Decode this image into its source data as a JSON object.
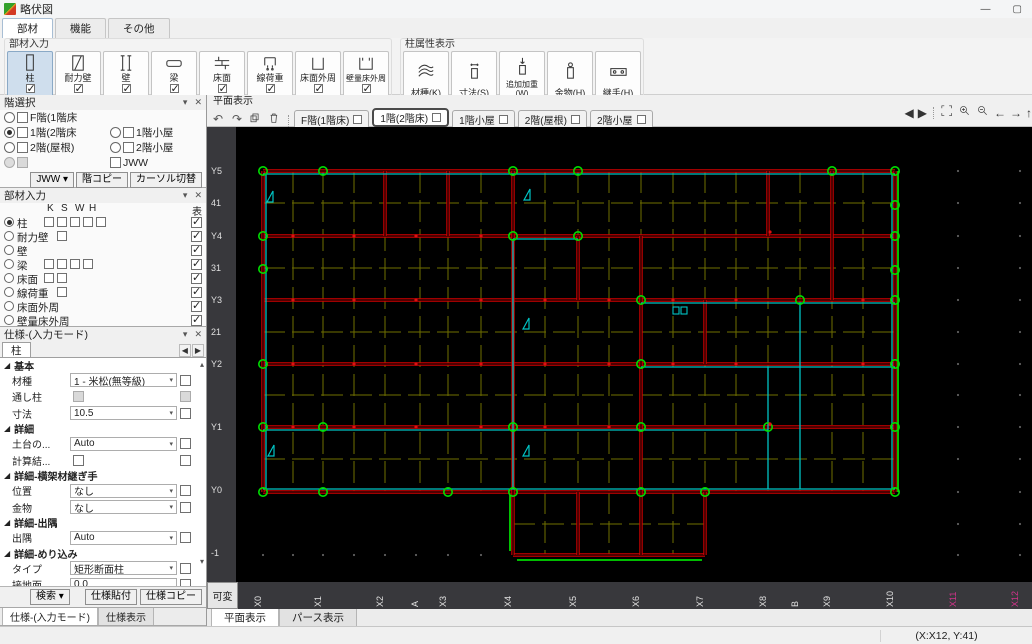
{
  "window": {
    "title": "略伏図",
    "controls": {
      "minimize": "—",
      "maximize": "▢"
    }
  },
  "ribbon": {
    "tabs": [
      {
        "label": "部材",
        "active": true
      },
      {
        "label": "機能",
        "active": false
      },
      {
        "label": "その他",
        "active": false
      }
    ],
    "member_group": {
      "title": "部材入力",
      "buttons": [
        {
          "label": "柱",
          "icon": "post-icon",
          "checked": true,
          "selected": true
        },
        {
          "label": "耐力壁",
          "icon": "bearing-wall-icon",
          "checked": true,
          "selected": false
        },
        {
          "label": "壁",
          "icon": "wall-icon",
          "checked": true,
          "selected": false
        },
        {
          "label": "梁",
          "icon": "beam-icon",
          "checked": true,
          "selected": false
        },
        {
          "label": "床面",
          "icon": "floor-icon",
          "checked": true,
          "selected": false
        },
        {
          "label": "線荷重",
          "icon": "line-load-icon",
          "checked": true,
          "selected": false
        },
        {
          "label": "床面外周",
          "icon": "floor-perimeter-icon",
          "checked": true,
          "selected": false
        },
        {
          "label": "壁量床外周",
          "icon": "wall-floor-perimeter-icon",
          "checked": true,
          "selected": false
        }
      ]
    },
    "attr_group": {
      "title": "柱属性表示",
      "buttons": [
        {
          "label": "材種(K)",
          "icon": "material-icon"
        },
        {
          "label": "寸法(S)",
          "icon": "size-icon"
        },
        {
          "label": "追加加重(W)",
          "icon": "added-load-icon"
        },
        {
          "label": "金物(H)",
          "icon": "hardware-icon"
        },
        {
          "label": "継手(H)",
          "icon": "joint-icon"
        }
      ]
    }
  },
  "floor_panel": {
    "title": "階選択",
    "rows": [
      {
        "col1": {
          "radio": true,
          "selected": false,
          "checkbox": true,
          "label": "F階(1階床"
        },
        "col2": null
      },
      {
        "col1": {
          "radio": true,
          "selected": true,
          "checkbox": true,
          "label": "1階(2階床"
        },
        "col2": {
          "radio": true,
          "selected": false,
          "checkbox": true,
          "label": "1階小屋"
        }
      },
      {
        "col1": {
          "radio": true,
          "selected": false,
          "checkbox": true,
          "label": "2階(屋根)"
        },
        "col2": {
          "radio": true,
          "selected": false,
          "checkbox": true,
          "label": "2階小屋"
        }
      },
      {
        "col1": {
          "radio": true,
          "disabled": true,
          "checkbox": true,
          "label": ""
        },
        "col2": {
          "radio": false,
          "checkbox": true,
          "label": "JWW"
        }
      }
    ],
    "buttons": [
      {
        "label": "JWW",
        "dropdown": true
      },
      {
        "label": "階コピー",
        "dropdown": false
      },
      {
        "label": "カーソル切替",
        "dropdown": false
      }
    ]
  },
  "member_panel": {
    "title": "部材入力",
    "col_letters": [
      "K",
      "S",
      "W",
      "H"
    ],
    "col_show": "表",
    "rows": [
      {
        "label": "柱",
        "selected": true,
        "boxes": 5,
        "offset": 0,
        "show": true
      },
      {
        "label": "耐力壁",
        "selected": false,
        "boxes": 1,
        "offset": 1,
        "show": true
      },
      {
        "label": "壁",
        "selected": false,
        "boxes": 0,
        "offset": 0,
        "show": true
      },
      {
        "label": "梁",
        "selected": false,
        "boxes": 4,
        "offset": 0,
        "show": true
      },
      {
        "label": "床面",
        "selected": false,
        "boxes": 2,
        "offset": 0,
        "show": true
      },
      {
        "label": "線荷重",
        "selected": false,
        "boxes": 1,
        "offset": 1,
        "show": true
      },
      {
        "label": "床面外周",
        "selected": false,
        "boxes": 0,
        "offset": 0,
        "show": true
      },
      {
        "label": "壁量床外周",
        "selected": false,
        "boxes": 0,
        "offset": 0,
        "show": true
      }
    ]
  },
  "spec_panel": {
    "title": "仕様-(入力モード)",
    "tab": "柱",
    "sections": [
      {
        "header": "基本",
        "rows": [
          {
            "label": "材種",
            "value": "1 - 米松(無等級)",
            "type": "select"
          },
          {
            "label": "通し柱",
            "value": "",
            "type": "disabled-check"
          },
          {
            "label": "寸法",
            "value": "10.5",
            "type": "select"
          }
        ]
      },
      {
        "header": "詳細",
        "rows": [
          {
            "label": "土台の...",
            "value": "Auto",
            "type": "select"
          },
          {
            "label": "計算結...",
            "value": "",
            "type": "check"
          }
        ]
      },
      {
        "header": "詳細-横架材継ぎ手",
        "rows": [
          {
            "label": "位置",
            "value": "なし",
            "type": "select"
          },
          {
            "label": "金物",
            "value": "なし",
            "type": "select"
          }
        ]
      },
      {
        "header": "詳細-出隅",
        "rows": [
          {
            "label": "出隅",
            "value": "Auto",
            "type": "select"
          }
        ]
      },
      {
        "header": "詳細-めり込み",
        "rows": [
          {
            "label": "タイプ",
            "value": "矩形断面柱",
            "type": "select"
          },
          {
            "label": "接地面...",
            "value": "0.0",
            "type": "text"
          }
        ]
      }
    ],
    "footer_buttons": [
      {
        "label": "検索",
        "dropdown": true
      },
      {
        "label": "仕様貼付",
        "dropdown": false
      },
      {
        "label": "仕様コピー",
        "dropdown": false
      }
    ],
    "bottom_tabs": [
      {
        "label": "仕様-(入力モード)",
        "active": true
      },
      {
        "label": "仕様表示",
        "active": false
      }
    ]
  },
  "canvas": {
    "header": "平面表示",
    "toolbar_icons": [
      "undo-icon",
      "redo-icon",
      "copy-icon",
      "delete-icon"
    ],
    "floor_tabs": [
      {
        "label": "F階(1階床)",
        "active": false
      },
      {
        "label": "1階(2階床)",
        "active": true
      },
      {
        "label": "1階小屋",
        "active": false
      },
      {
        "label": "2階(屋根)",
        "active": false
      },
      {
        "label": "2階小屋",
        "active": false
      }
    ],
    "nav_icons": [
      "pane-left-icon",
      "pane-right-icon",
      "zoom-fit-icon",
      "zoom-in-icon",
      "zoom-out-icon",
      "pan-left-icon",
      "pan-right-icon",
      "pan-up-icon"
    ],
    "variable_button": "可変",
    "view_tabs": [
      {
        "label": "平面表示",
        "active": true
      },
      {
        "label": "パース表示",
        "active": false
      }
    ],
    "y_axis": [
      {
        "label": "Y5",
        "y": 44
      },
      {
        "label": "41",
        "y": 76
      },
      {
        "label": "Y4",
        "y": 109
      },
      {
        "label": "31",
        "y": 141
      },
      {
        "label": "Y3",
        "y": 173
      },
      {
        "label": "21",
        "y": 205
      },
      {
        "label": "Y2",
        "y": 237
      },
      {
        "label": "Y1",
        "y": 300
      },
      {
        "label": "Y0",
        "y": 363
      },
      {
        "label": "-1",
        "y": 426
      }
    ],
    "x_axis": [
      {
        "label": "X0",
        "x": 25,
        "highlight": false
      },
      {
        "label": "X1",
        "x": 85,
        "highlight": false
      },
      {
        "label": "X2",
        "x": 147,
        "highlight": false
      },
      {
        "label": "A",
        "x": 182,
        "highlight": false
      },
      {
        "label": "X3",
        "x": 210,
        "highlight": false
      },
      {
        "label": "X4",
        "x": 275,
        "highlight": false
      },
      {
        "label": "X5",
        "x": 340,
        "highlight": false
      },
      {
        "label": "X6",
        "x": 403,
        "highlight": false
      },
      {
        "label": "X7",
        "x": 467,
        "highlight": false
      },
      {
        "label": "X8",
        "x": 530,
        "highlight": false
      },
      {
        "label": "B",
        "x": 562,
        "highlight": false
      },
      {
        "label": "X9",
        "x": 594,
        "highlight": false
      },
      {
        "label": "X10",
        "x": 657,
        "highlight": false
      },
      {
        "label": "X11",
        "x": 720,
        "highlight": true
      },
      {
        "label": "X12",
        "x": 782,
        "highlight": true
      }
    ],
    "highlight_color": "#d4338c"
  },
  "statusbar": {
    "coords": "(X:X12, Y:41)"
  },
  "drawing": {
    "width": 796,
    "height": 455,
    "bg": "#000000",
    "colors": {
      "grid": "#6f6f00",
      "beam": "#d40000",
      "cyan": "#00c4c4",
      "green": "#00d800",
      "circle": "#00dd00",
      "red_dot": "#e01010",
      "faint_dot": "#5f5f5f"
    },
    "grid_x": [
      27,
      57,
      87,
      118,
      149,
      184,
      212,
      245,
      277,
      309,
      342,
      373,
      405,
      437,
      469,
      500,
      532,
      564,
      596,
      627,
      659
    ],
    "grid_y": [
      44,
      76,
      109,
      141,
      173,
      205,
      237,
      268,
      300,
      332,
      365
    ],
    "grid_x_span": [
      44,
      365
    ],
    "grid_y_span": [
      27,
      659
    ],
    "porch": {
      "x1": 277,
      "x2": 469,
      "y1": 365,
      "y2": 428,
      "grid_x": [
        309,
        342,
        373,
        405,
        437
      ],
      "grid_y": [
        397
      ]
    },
    "beams_red_h": [
      [
        27,
        44,
        659
      ],
      [
        27,
        109,
        659
      ],
      [
        27,
        173,
        659
      ],
      [
        27,
        237,
        659
      ],
      [
        27,
        300,
        659
      ],
      [
        27,
        365,
        659
      ],
      [
        277,
        428,
        469
      ]
    ],
    "beams_red_v": [
      [
        27,
        44,
        365
      ],
      [
        149,
        44,
        109
      ],
      [
        212,
        44,
        109
      ],
      [
        277,
        44,
        365
      ],
      [
        342,
        109,
        173
      ],
      [
        405,
        109,
        365
      ],
      [
        469,
        173,
        237
      ],
      [
        532,
        44,
        109
      ],
      [
        596,
        44,
        173
      ],
      [
        659,
        44,
        365
      ],
      [
        277,
        365,
        428
      ],
      [
        342,
        365,
        428
      ],
      [
        405,
        365,
        428
      ],
      [
        469,
        365,
        428
      ]
    ],
    "cyan_h": [
      [
        27,
        47,
        659
      ],
      [
        27,
        362,
        659
      ],
      [
        277,
        112,
        342
      ],
      [
        405,
        176,
        659
      ],
      [
        405,
        240,
        659
      ],
      [
        27,
        303,
        532
      ]
    ],
    "cyan_v": [
      [
        30,
        47,
        362
      ],
      [
        656,
        47,
        362
      ],
      [
        277,
        112,
        362
      ],
      [
        564,
        176,
        362
      ],
      [
        532,
        240,
        362
      ]
    ],
    "green_lines": [
      [
        662,
        44,
        662,
        365
      ],
      [
        274,
        368,
        274,
        424
      ],
      [
        281,
        433,
        466,
        433
      ]
    ],
    "circles": [
      [
        27,
        44
      ],
      [
        87,
        44
      ],
      [
        277,
        44
      ],
      [
        342,
        44
      ],
      [
        596,
        44
      ],
      [
        659,
        44
      ],
      [
        27,
        109
      ],
      [
        277,
        109
      ],
      [
        342,
        109
      ],
      [
        659,
        78
      ],
      [
        659,
        109
      ],
      [
        27,
        142
      ],
      [
        405,
        173
      ],
      [
        564,
        173
      ],
      [
        659,
        143
      ],
      [
        659,
        173
      ],
      [
        27,
        237
      ],
      [
        405,
        237
      ],
      [
        659,
        237
      ],
      [
        27,
        300
      ],
      [
        87,
        300
      ],
      [
        277,
        300
      ],
      [
        405,
        300
      ],
      [
        532,
        300
      ],
      [
        659,
        300
      ],
      [
        27,
        365
      ],
      [
        87,
        365
      ],
      [
        212,
        365
      ],
      [
        277,
        365
      ],
      [
        405,
        365
      ],
      [
        469,
        365
      ],
      [
        659,
        365
      ]
    ],
    "red_dots": [
      [
        57,
        109
      ],
      [
        118,
        109
      ],
      [
        180,
        109
      ],
      [
        245,
        109
      ],
      [
        57,
        173
      ],
      [
        118,
        173
      ],
      [
        180,
        173
      ],
      [
        245,
        173
      ],
      [
        309,
        173
      ],
      [
        373,
        173
      ],
      [
        437,
        173
      ],
      [
        500,
        173
      ],
      [
        627,
        173
      ],
      [
        57,
        237
      ],
      [
        118,
        237
      ],
      [
        180,
        237
      ],
      [
        245,
        237
      ],
      [
        309,
        237
      ],
      [
        373,
        237
      ],
      [
        437,
        237
      ],
      [
        500,
        237
      ],
      [
        627,
        237
      ],
      [
        57,
        300
      ],
      [
        118,
        300
      ],
      [
        180,
        300
      ],
      [
        245,
        300
      ],
      [
        309,
        300
      ],
      [
        373,
        300
      ],
      [
        534,
        105
      ],
      [
        534,
        297
      ]
    ],
    "faint_cols": [
      722,
      784
    ],
    "faint_rows": [
      44,
      76,
      109,
      141,
      173,
      205,
      237,
      268,
      300,
      332,
      365,
      397,
      428
    ],
    "faint_bottom_xs": [
      27,
      57,
      87,
      118,
      149,
      180,
      212,
      245
    ],
    "faint_bottom_y": 428,
    "brace_marks": [
      [
        31,
        75
      ],
      [
        288,
        73
      ],
      [
        287,
        202
      ],
      [
        32,
        329
      ],
      [
        287,
        329
      ]
    ],
    "pair_mark": [
      437,
      180
    ]
  }
}
